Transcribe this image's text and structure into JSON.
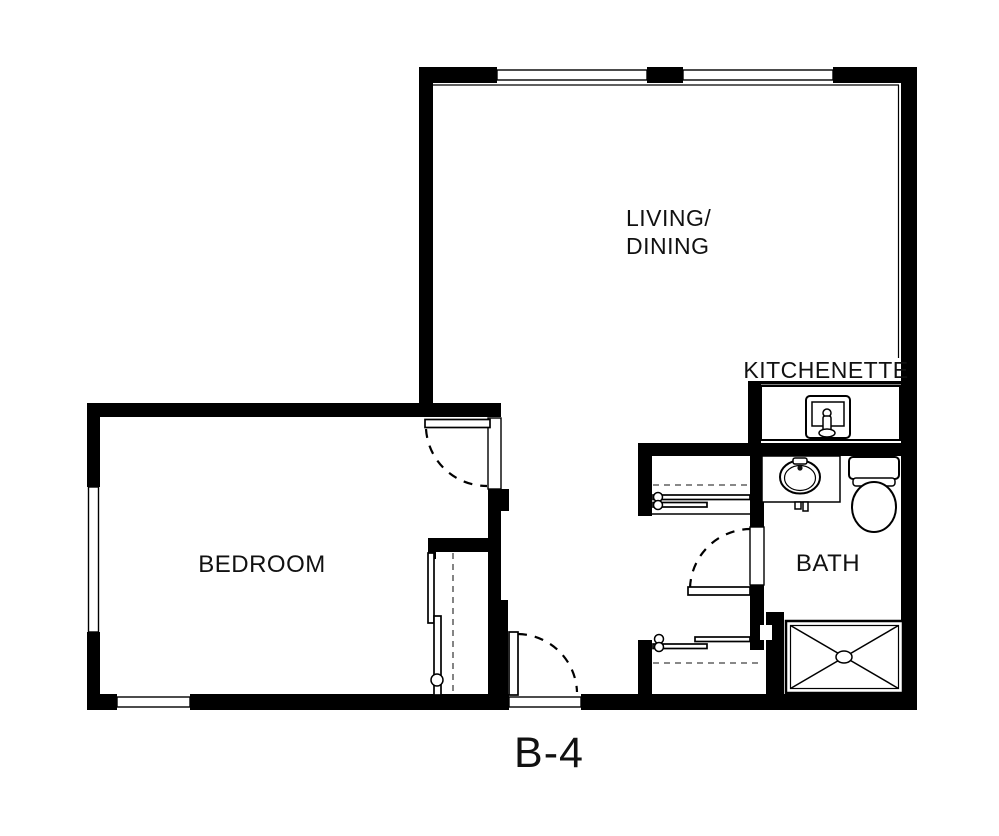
{
  "plan": {
    "unit_label": "B-4"
  },
  "rooms": {
    "living_dining": {
      "label_line1": "LIVING/",
      "label_line2": "DINING"
    },
    "kitchenette": {
      "label": "KITCHENETTE"
    },
    "bedroom": {
      "label": "BEDROOM"
    },
    "bath": {
      "label": "BATH"
    }
  },
  "colors": {
    "walls": "#000000",
    "background": "#ffffff",
    "text": "#111111"
  }
}
